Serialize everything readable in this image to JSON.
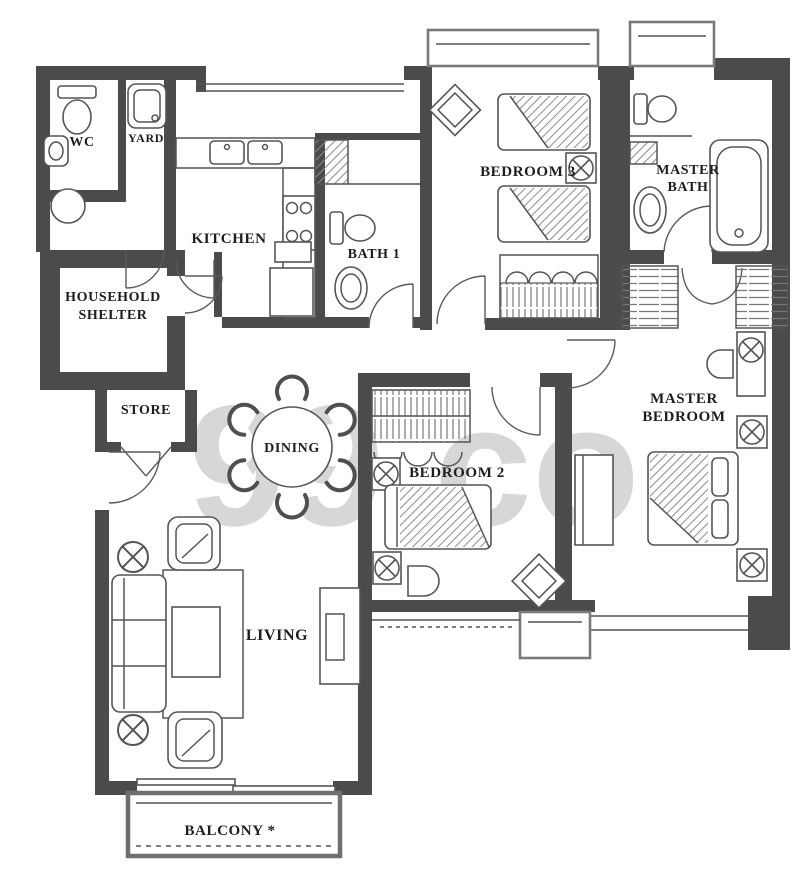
{
  "watermark": {
    "text": "99.co",
    "color": "#d7d7d7"
  },
  "colors": {
    "wall": "#4b4b4b",
    "line": "#555555",
    "label": "#1d1d1d"
  },
  "rooms": {
    "wc": {
      "label": "WC"
    },
    "yard": {
      "label": "YARD"
    },
    "kitchen": {
      "label": "KITCHEN"
    },
    "bath1": {
      "label": "BATH 1"
    },
    "bedroom3": {
      "label": "BEDROOM 3"
    },
    "master_bath": {
      "line1": "MASTER",
      "line2": "BATH"
    },
    "household_shelter": {
      "line1": "HOUSEHOLD",
      "line2": "SHELTER"
    },
    "store": {
      "label": "STORE"
    },
    "dining": {
      "label": "DINING"
    },
    "bedroom2": {
      "label": "BEDROOM 2"
    },
    "master_bedroom": {
      "line1": "MASTER",
      "line2": "BEDROOM"
    },
    "living": {
      "label": "LIVING"
    },
    "balcony": {
      "label": "BALCONY *"
    }
  }
}
